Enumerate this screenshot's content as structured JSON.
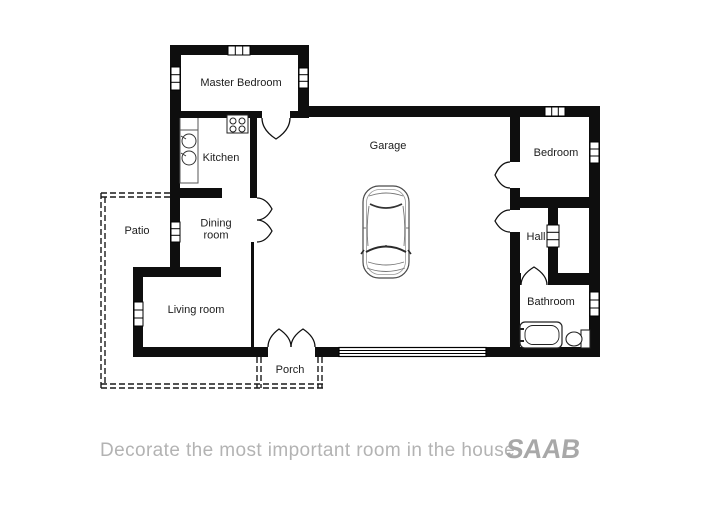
{
  "page": {
    "background": "#ffffff"
  },
  "floor_plan": {
    "wall_color": "#0e0e0e",
    "rooms": [
      {
        "id": "master-bedroom",
        "label": "Master Bedroom"
      },
      {
        "id": "kitchen",
        "label": "Kitchen"
      },
      {
        "id": "dining-room",
        "label": "Dining room"
      },
      {
        "id": "patio",
        "label": "Patio"
      },
      {
        "id": "living-room",
        "label": "Living room"
      },
      {
        "id": "garage",
        "label": "Garage"
      },
      {
        "id": "bedroom",
        "label": "Bedroom"
      },
      {
        "id": "hall",
        "label": "Hall"
      },
      {
        "id": "bathroom",
        "label": "Bathroom"
      },
      {
        "id": "porch",
        "label": "Porch"
      }
    ],
    "fixtures": [
      "car-icon",
      "stove-icon",
      "sink-icon",
      "bathtub-icon",
      "toilet-icon",
      "garage-door"
    ]
  },
  "footer": {
    "tagline": "Decorate the most important room in the house",
    "brand": "SAAB",
    "tagline_color": "#b3b3b3",
    "brand_color": "#a8a8a8"
  }
}
